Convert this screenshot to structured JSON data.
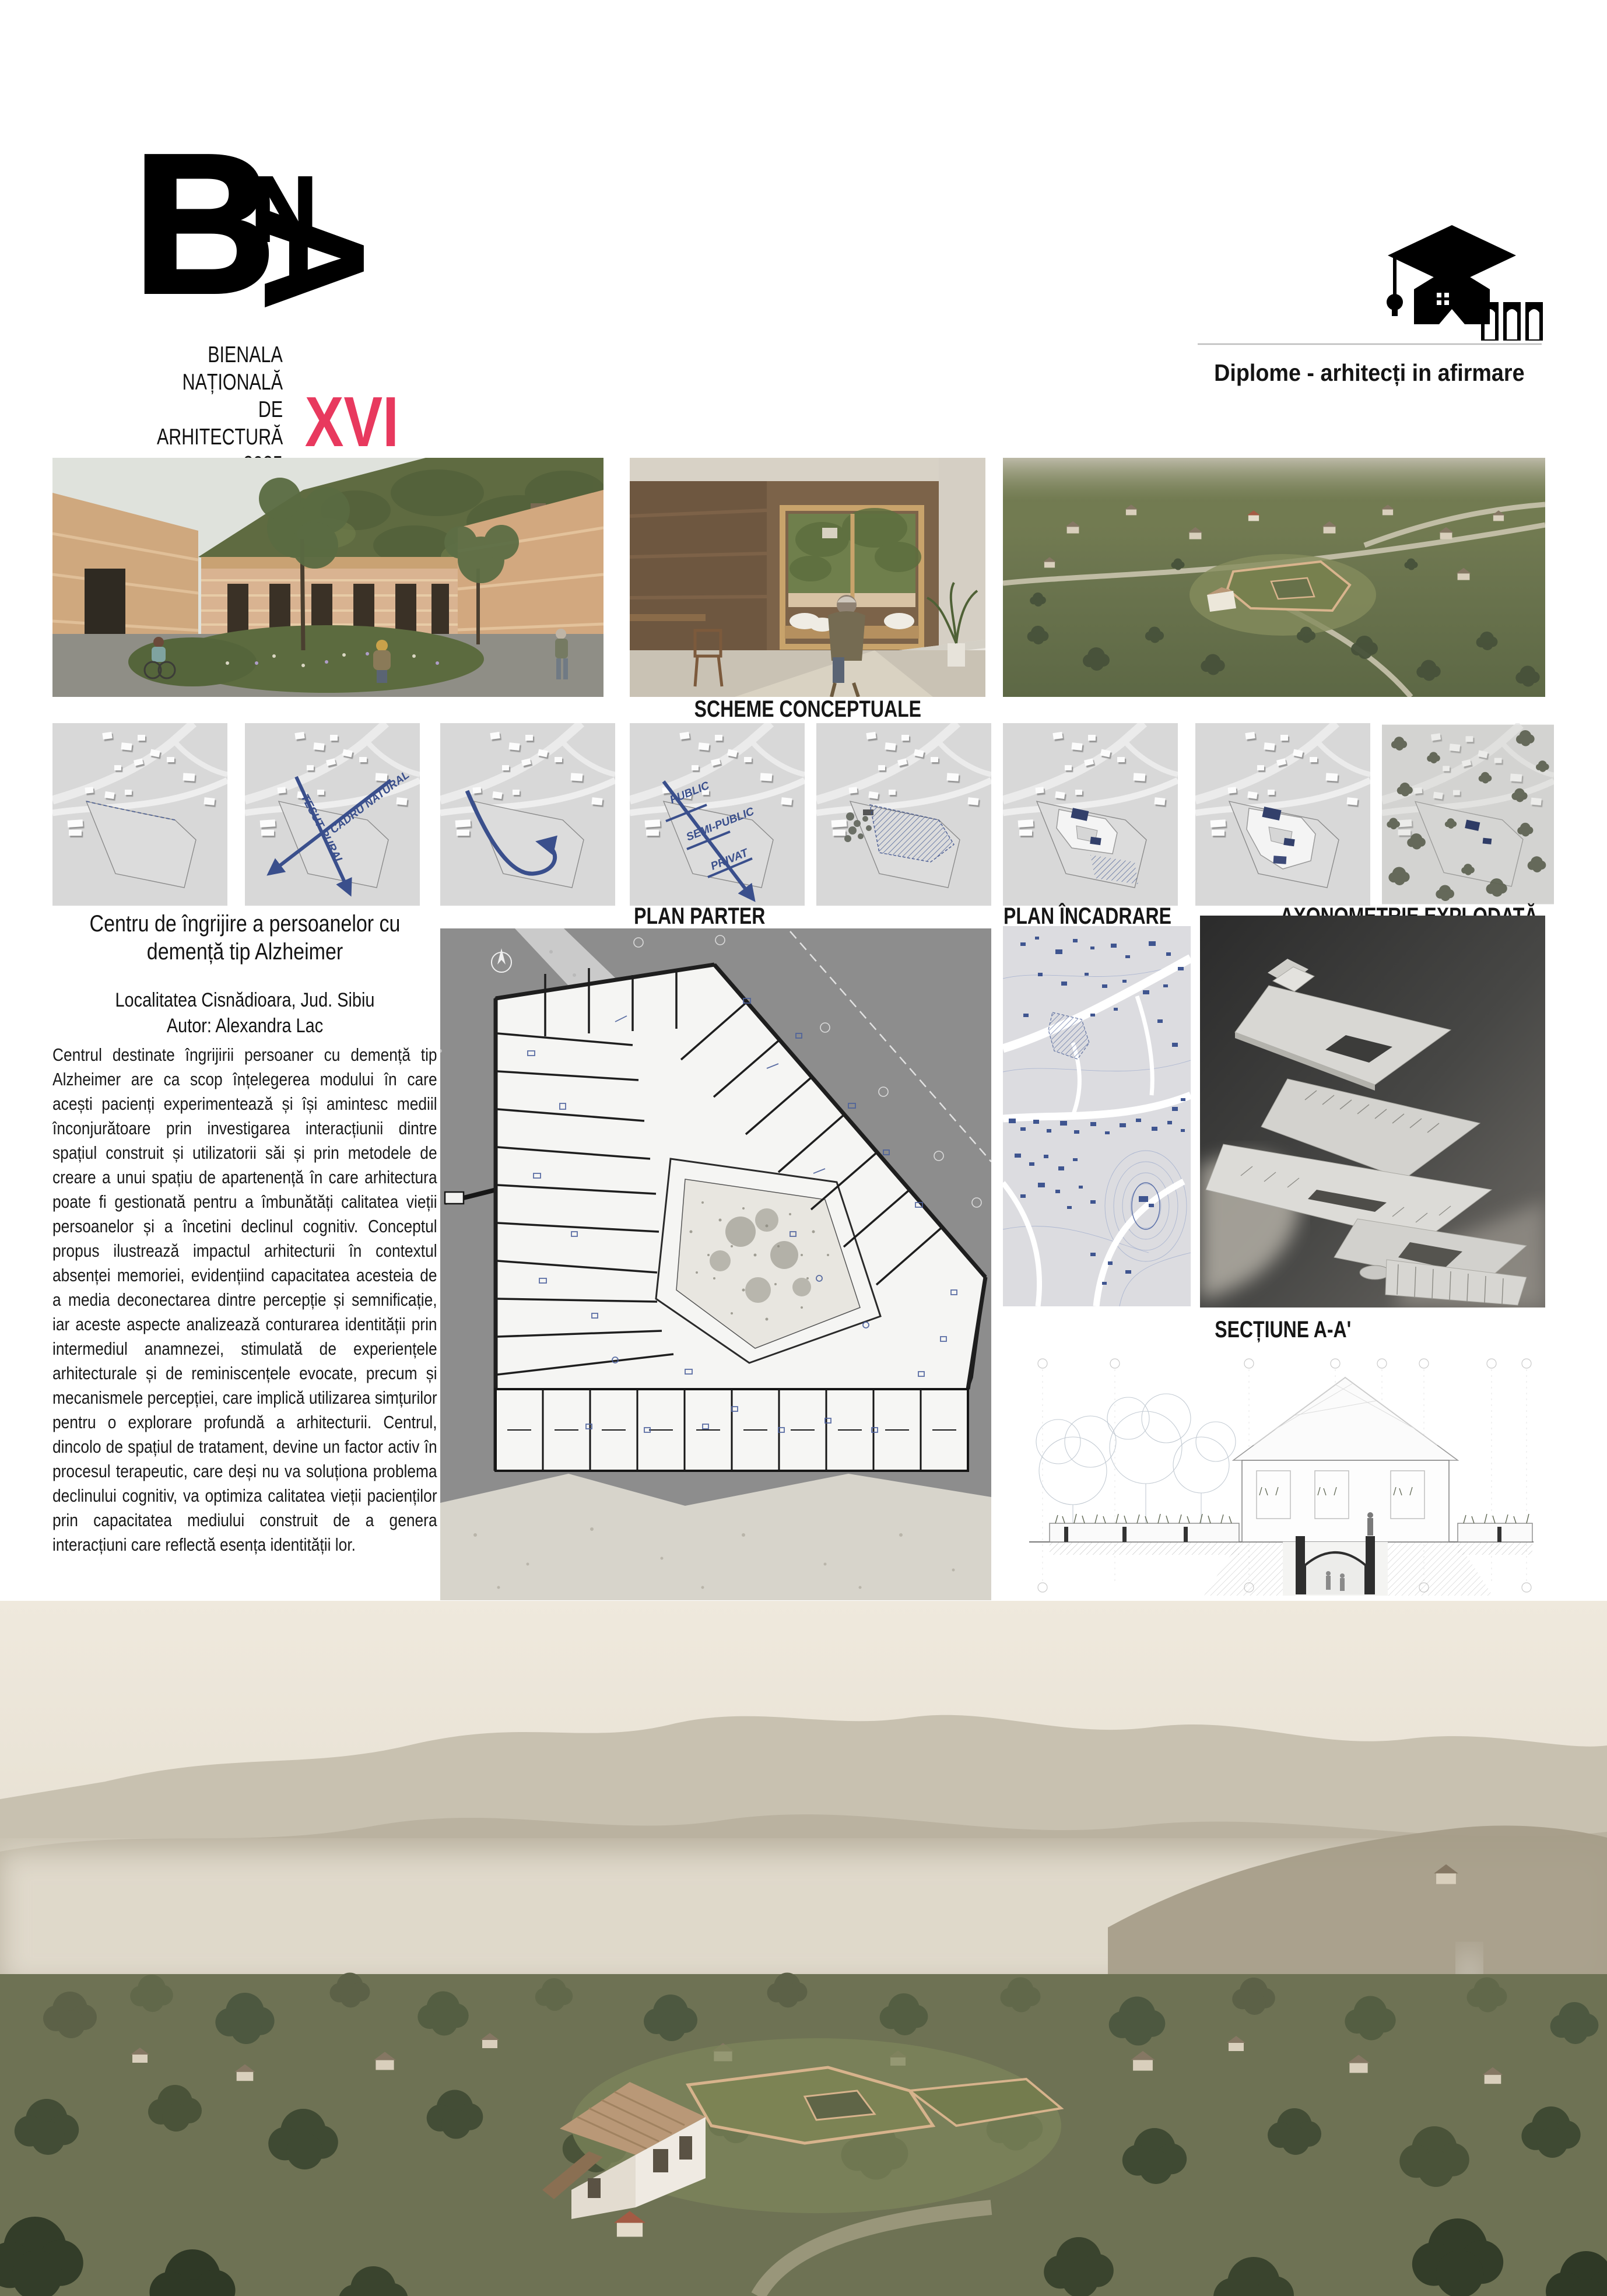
{
  "header": {
    "bna": {
      "letter_b": "B",
      "letter_n": "N",
      "letter_a": "A",
      "lines": [
        "BIENALA",
        "NAȚIONALĂ",
        "DE",
        "ARHITECTURĂ",
        "2025"
      ],
      "edition": "XVI",
      "accent_color": "#e8395e"
    },
    "diplome": {
      "label": "Diplome - arhitecți in afirmare"
    }
  },
  "section_labels": {
    "schemes": "SCHEME CONCEPTUALE",
    "plan_parter": "PLAN PARTER",
    "plan_incadrare": "PLAN ÎNCADRARE",
    "axonometrie": "AXONOMETRIE EXPLODATĂ",
    "sectiune": "SECȚIUNE A-A'"
  },
  "schemes": {
    "annotations": {
      "tesut_rural": "TESUT RURAL",
      "cadru_natural": "CADRU NATURAL",
      "public": "PUBLIC",
      "semi_public": "SEMI-PUBLIC",
      "privat": "PRIVAT"
    }
  },
  "project": {
    "title": "Centru de îngrijire a persoanelor cu demență tip Alzheimer",
    "location": "Localitatea Cisnădioara, Jud. Sibiu",
    "author": "Autor: Alexandra Lac",
    "description": "Centrul destinate îngrijirii persoaner cu demență tip Alzheimer are ca scop înțelegerea modului în care acești pacienți experimentează și își amintesc mediil înconjurătoare prin investigarea interacțiunii dintre spațiul construit și utilizatorii săi și prin metodele de creare a unui spațiu de apartenență în care arhitectura poate fi gestionată pentru a îmbunătăți calitatea vieții persoanelor și a încetini declinul cognitiv. Conceptul propus ilustrează impactul arhitecturii în contextul absenței memoriei, evidențiind capacitatea acesteia de a media deconectarea dintre percepție și semnificație, iar aceste aspecte analizează conturarea identității prin intermediul anamnezei, stimulată de experiențele arhitecturale și de reminiscențele evocate, precum și mecanismele percepției, care implică utilizarea simțurilor pentru o explorare profundă a arhitecturii. Centrul, dincolo de spațiul de tratament, devine un factor activ în procesul terapeutic, care deși nu va soluționa problema declinului cognitiv, va optimiza calitatea vieții pacienților prin capacitatea mediului construit de a genera interacțiuni care reflectă esența identității lor."
  },
  "colors": {
    "accent_pink": "#e8395e",
    "diagram_blue": "#3c5390"
  }
}
